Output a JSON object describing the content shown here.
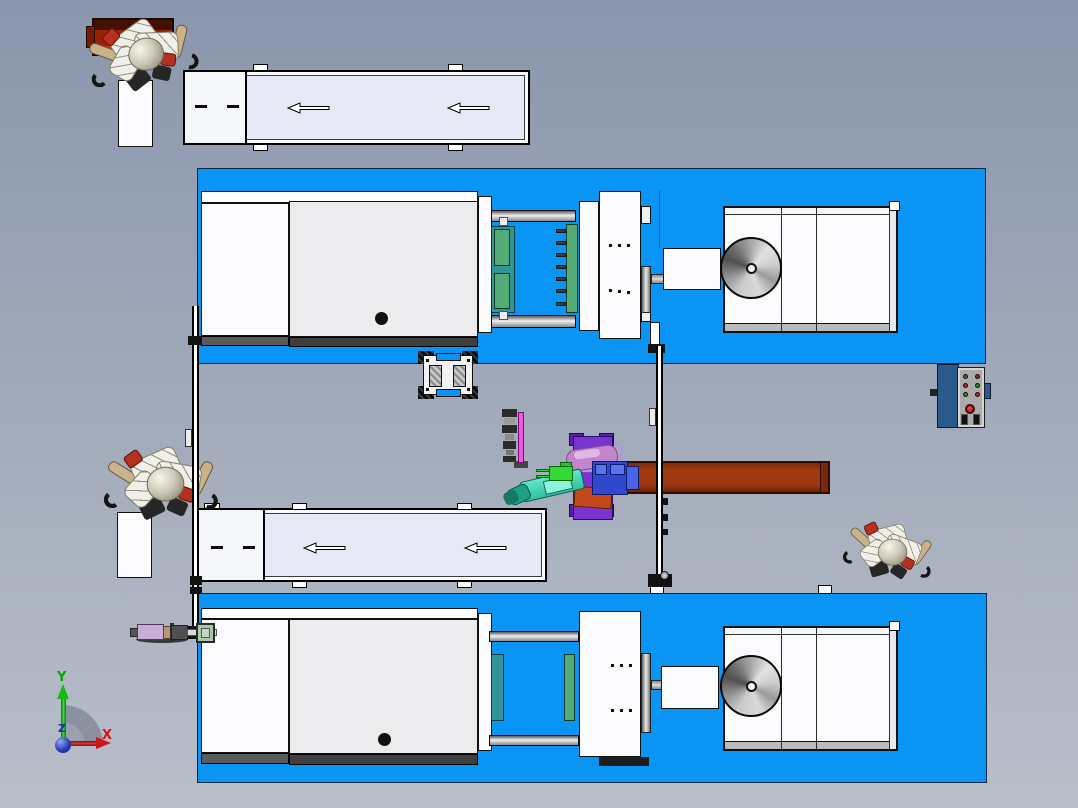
{
  "scene": {
    "view": "top",
    "content": "dual injection molding machine cell with conveyors, handling robots, safety fences and control panel"
  },
  "triad": {
    "x_label": "X",
    "y_label": "Y",
    "z_label": "Z"
  },
  "conveyors": {
    "count": 2,
    "arrow_direction": "left",
    "arrows_per_belt": 2
  },
  "machines": {
    "count": 2,
    "cabinet_sections": 3,
    "hopper_disc_per_machine": 1
  },
  "control_panel": {
    "small_buttons": 6,
    "estop_buttons": 1,
    "slots": 2
  },
  "robots": {
    "small_gray_robots": 3,
    "handling_robot_cells": 1
  },
  "colors": {
    "bg-top": "#8A96AC",
    "bg-bottom": "#B9BEC9",
    "platform-blue": "#0A95F5",
    "machine-white": "#FBFBFD",
    "machine-gray": "#ECECEE",
    "strip-dark": "#474747",
    "belt": "#E7EAF6",
    "conveyor-box": "#F6F7FB",
    "tote-red": "#9A2007",
    "tote-red-dark": "#431008",
    "tote-red-bright": "#DD2B0B",
    "beam-brown": "#9C3711",
    "teal-plate": "#2F9598",
    "mold-green": "#53AC78",
    "bright-green": "#35D935",
    "arm-teal": "#46D8B8",
    "post-magenta": "#F056E6",
    "base-purple": "#7A35D0",
    "base-purple-dark": "#5A22A8",
    "unit-blue": "#3148CE",
    "unit-blue-light": "#5A74F0",
    "orange-part": "#C3491C",
    "violet-arm": "#C285CE",
    "panel-blue": "#2B5A8C",
    "panel-gray": "#ABABAB",
    "robot-body": "#F0EFE8",
    "robot-tan": "#C9B38C",
    "robot-red": "#B5301E",
    "actuator-lavender": "#C9AFD8",
    "actuator-green": "#A9C9A9",
    "axis-red": "#DD1111",
    "axis-green": "#00A800",
    "axis-blue": "#1A2FA0"
  }
}
